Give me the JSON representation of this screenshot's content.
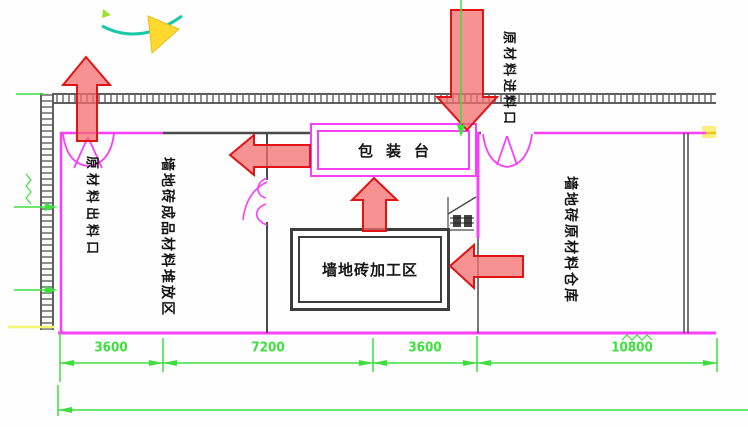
{
  "drawing": {
    "type": "factory-floor-plan",
    "rooms": {
      "outlet_label": "原材料出料口",
      "finished_storage_label": "墙地砖成品材料堆放区",
      "packing_table_label": "包装台",
      "processing_area_label": "墙地砖加工区",
      "warehouse_label": "墙地砖原材料仓库",
      "inlet_label": "原材料进料口"
    },
    "dimensions": {
      "segments": [
        "3600",
        "7200",
        "3600",
        "10800"
      ]
    },
    "colors": {
      "wall_magenta": "#f840f8",
      "dimension_green": "#3ddf3d",
      "arrow_fill": "#f46e6e",
      "arrow_stroke": "#e01414",
      "wall_gray": "#4a4a4a",
      "highlight_yellow": "#ffe13a"
    }
  }
}
